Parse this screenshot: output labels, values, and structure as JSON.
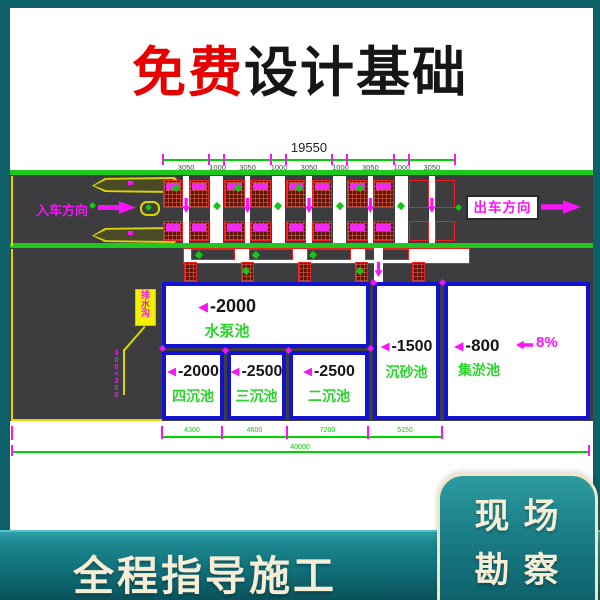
{
  "title": {
    "free": "免费",
    "rest": "设计基础"
  },
  "drawing": {
    "dims": {
      "total_top": "19550",
      "top": [
        "3050",
        "1000",
        "3050",
        "1000",
        "3050",
        "1000",
        "3050",
        "1000",
        "3050"
      ],
      "bottom": [
        "4300",
        "4600",
        "7200",
        "5150"
      ],
      "overall": "40000"
    },
    "labels": {
      "entry": "入车方向",
      "exit": "出车方向",
      "slope_value": "8%",
      "tri": "◀",
      "annotation": "排水沟",
      "annotation_note": "300×300"
    },
    "pools": {
      "pump": {
        "depth": "-2000",
        "name": "水泵池"
      },
      "fourth": {
        "depth": "-2000",
        "name": "四沉池"
      },
      "third": {
        "depth": "-2500",
        "name": "三沉池"
      },
      "second": {
        "depth": "-2500",
        "name": "二沉池"
      },
      "sand": {
        "depth": "-1500",
        "name": "沉砂池"
      },
      "sludge": {
        "depth": "-800",
        "name": "集淤池"
      }
    }
  },
  "banner": {
    "left": "全程指导施工",
    "right": [
      "现场",
      "勘察"
    ]
  },
  "colors": {
    "magenta": "#f913f9",
    "cad_green": "#1ec81e",
    "dim_green": "#00d400",
    "pool_blue": "#1313cf",
    "hatch_red": "#ef1f1f",
    "road": "#3d3d40",
    "teal_frame": "#0d5f68",
    "banner_teal": "#11707a",
    "cream": "#f6edd6",
    "title_red": "#e60000"
  }
}
